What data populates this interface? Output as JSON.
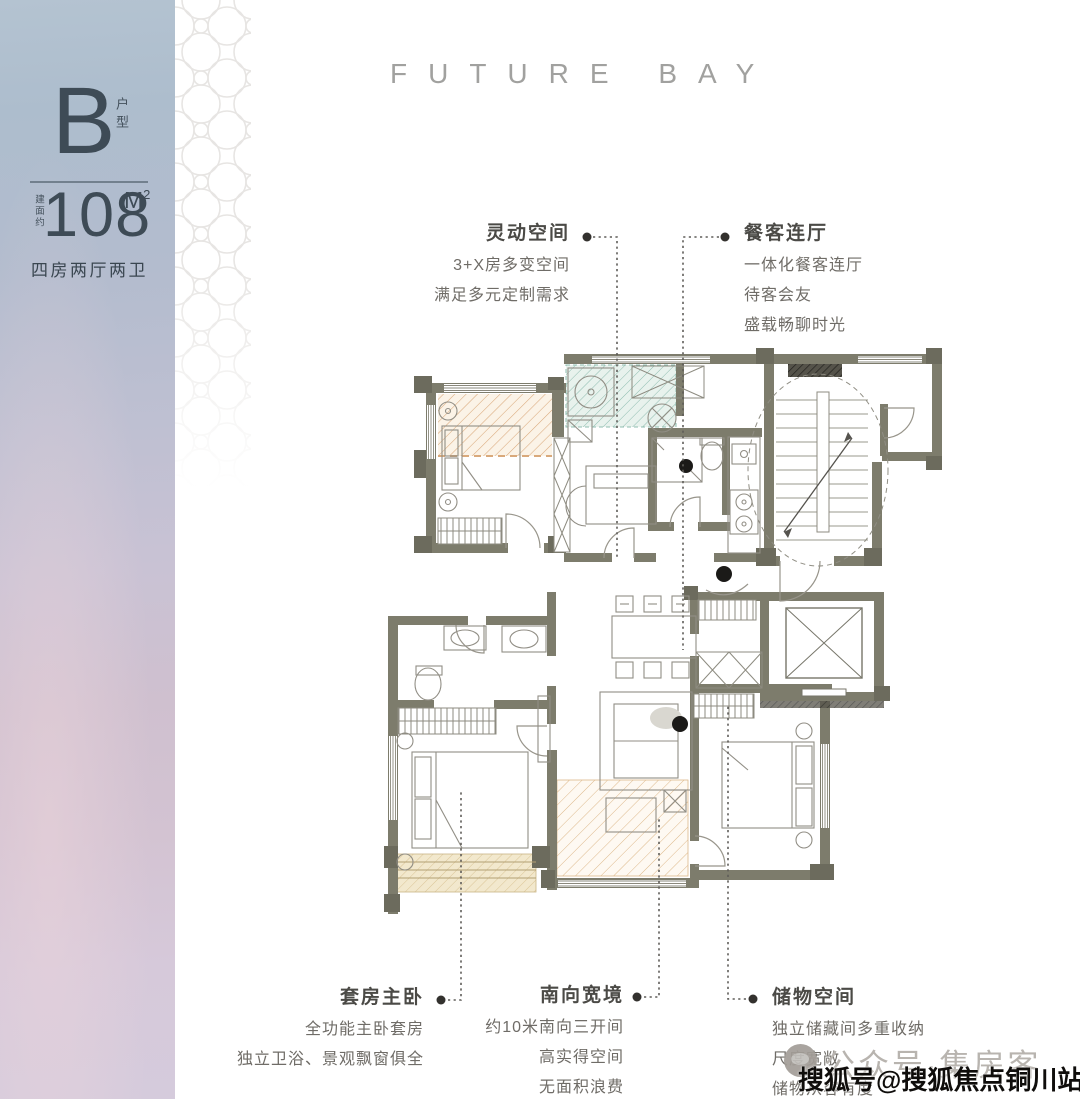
{
  "left_panel": {
    "unit_letter": "B",
    "unit_suffix": "户型",
    "area_prefix": "建面约",
    "area_value": "108",
    "area_unit": "M",
    "area_unit_sup": "2",
    "layout_text": "四房两厅两卫"
  },
  "header": {
    "title": "FUTURE BAY"
  },
  "callouts": [
    {
      "id": "flex-space",
      "title": "灵动空间",
      "lines": [
        "3+X房多变空间",
        "满足多元定制需求"
      ]
    },
    {
      "id": "dining",
      "title": "餐客连厅",
      "lines": [
        "一体化餐客连厅",
        "待客会友",
        "盛载畅聊时光"
      ]
    },
    {
      "id": "master-suite",
      "title": "套房主卧",
      "lines": [
        "全功能主卧套房",
        "独立卫浴、景观飘窗俱全"
      ]
    },
    {
      "id": "south-span",
      "title": "南向宽境",
      "lines": [
        "约10米南向三开间",
        "高实得空间",
        "无面积浪费"
      ]
    },
    {
      "id": "storage",
      "title": "储物空间",
      "lines": [
        "独立储藏间多重收纳",
        "尺度宽敞",
        "储物从容有度"
      ]
    }
  ],
  "watermarks": {
    "gray_text": "公众号·集房客",
    "black_text": "搜狐号@搜狐焦点铜川站"
  },
  "colors": {
    "wall": "#7d7c6c",
    "pier": "#6c6b5d",
    "hatch_orange": "#d9a97b",
    "hatch_teal": "#8fbdb0",
    "hatch_tan": "#d9c190",
    "title_text": "#4b4a46",
    "body_text": "#6f6c67",
    "brand_text": "#a1a19f"
  }
}
